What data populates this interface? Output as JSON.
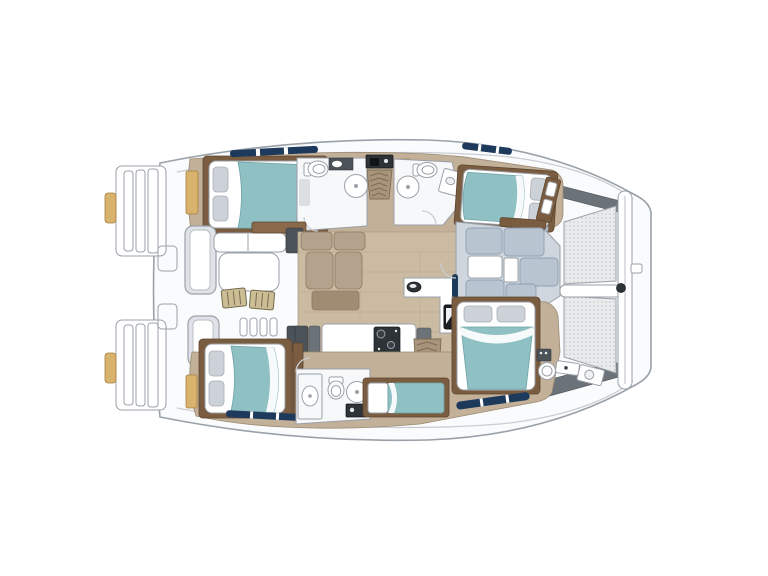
{
  "document": {
    "kind": "catamaran-deck-and-accommodation-floorplan",
    "orientation": "bow-right-stern-left",
    "background": "#ffffff"
  },
  "areas": {
    "boat": "Catamaran floor plan, top view",
    "swim_platform_port": "Port transom swim steps",
    "swim_platform_starboard": "Starboard transom swim steps",
    "cockpit": "Aft cockpit",
    "cockpit_bench_fwd": "Cockpit bench seat",
    "cockpit_bench_aft": "Cockpit bench seat",
    "cockpit_table": "Cockpit dining table",
    "cockpit_chairs": "Two folding deck chairs",
    "cockpit_steps": "Cockpit side steps",
    "salon": "Salon with wood sole",
    "salon_sofa": "L-shaped salon settee",
    "coffee_table": "Salon coffee table",
    "galley": "Galley island with stove",
    "stove": "Two-burner stove",
    "sink": "Galley sink",
    "fridge": "Refrigerator unit",
    "nav_counter": "Galley / nav counter",
    "companionway_port": "Stairs down to port hull",
    "companionway_starboard": "Stairs down to starboard hull",
    "cabin_aft_port": "Aft double cabin, port hull",
    "cabin_fwd_port": "Forward double cabin, port hull",
    "cabin_aft_starboard": "Aft double cabin, starboard hull",
    "cabin_fwd_starboard": "Forward double cabin, starboard hull",
    "single_berth": "Single skipper berth",
    "head_aft_port": "Aft head with shower, port",
    "head_fwd_port": "Forward head with shower, port",
    "head_starboard": "Starboard head with shower stall",
    "head_bow": "Bow crew head",
    "fwd_lounge": "Forward cockpit lounge",
    "trampoline": "Bow trampoline, two mesh panels",
    "bow_lockers": "Bow deck lockers",
    "hull_windows": "Hull window strips"
  },
  "inventory": {
    "double_beds": 4,
    "single_beds": 1,
    "heads_bathrooms": 4,
    "shower_rounds": 4,
    "cockpit_chairs": 2,
    "trampoline_panels": 2,
    "stairways": 2,
    "swim_platforms": 2
  },
  "colors": {
    "hull_fill": "#fafbfc",
    "hull_line": "#9aa1a8",
    "deck_line": "#c9cdd2",
    "wood": "#c2b098",
    "wood_light": "#ccbba3",
    "wood_dark": "#a8947b",
    "trim": "#7a5c40",
    "trim_light": "#8a6a4a",
    "bed_teal": "#8fc0c3",
    "bed_fold": "#ffffff",
    "pillow": "#ccd2d8",
    "bath_floor": "#f6f8f9",
    "sofa": "#b4a28c",
    "sofa_dark": "#a08b73",
    "lounge": "#b9c4d1",
    "lounge_dark": "#8da0b3",
    "lounge_base": "#cfd6dd",
    "mesh_bg": "#e9ebed",
    "mesh_dot": "#c3c8cd",
    "slate": "#6b7278",
    "slate_dark": "#4b5258",
    "dark": "#2e3338",
    "navy": "#1d3a5c",
    "tan": "#d9b26e",
    "khaki": "#cbbd94",
    "white": "#ffffff"
  }
}
